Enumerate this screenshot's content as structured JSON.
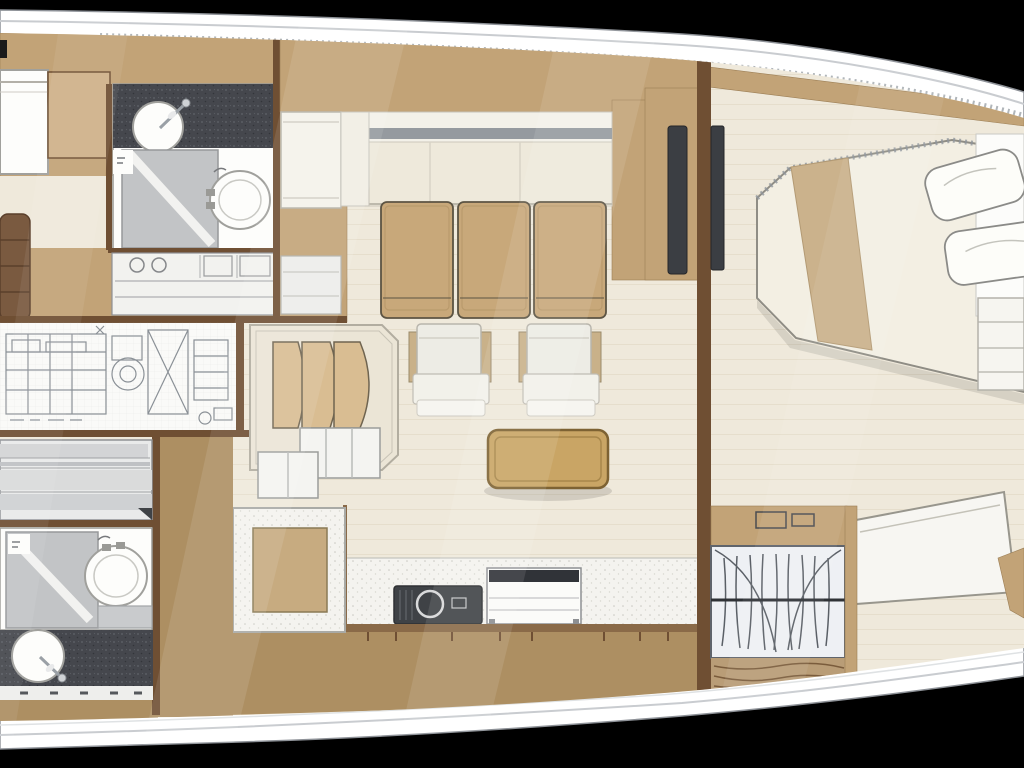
{
  "meta": {
    "title": "Sailing yacht interior deck plan",
    "description": "Top-down floor plan of a yacht interior; bow to the right, stern cropped at left"
  },
  "colors": {
    "background": "#000000",
    "hull": "#ffffff",
    "hullLine": "#c9ccd0",
    "stipple": "#8e959b",
    "wall": "#6f4f33",
    "wallLight": "#8a6a48",
    "cabinet": "#c2a377",
    "cabinetLight": "#cfb189",
    "deck": "#ad8f62",
    "floor": "#efe9db",
    "floorLine": "#ddd2bd",
    "sofa": "#f2efe6",
    "sofaStripe": "#959a9f",
    "chair": "#c8a87a",
    "chairOutline": "#5c5443",
    "armchair": "#edece5",
    "armchairArm": "#c9b189",
    "table": "#c9a565",
    "tableEdge": "#7d6233",
    "counterDark": "#45474d",
    "counterSpeckle": "#f4f3ef",
    "fixtureWhite": "#fdfdfb",
    "fixtureOutline": "#a0a09c",
    "showerGray": "#c2c4c6",
    "machinery": "#8a9096",
    "bedMattress": "#f3efe3",
    "bedBlanket": "#cbb28c",
    "bedStripe": "#d3d4d6",
    "stepsBrown": "#7a5a40",
    "tv": "#3b3e43",
    "wardrobe": "#eef0f4",
    "wardrobeLine": "#5f646c",
    "settee": "#d9bd92"
  },
  "rooms": {
    "aft_cabin_port": {
      "label": "Aft cabin (port)"
    },
    "ensuite_port": {
      "label": "Ensuite head with shower (port)"
    },
    "engine_room": {
      "label": "Engine room"
    },
    "aft_cabin_starboard": {
      "label": "Aft cabin (starboard)"
    },
    "ensuite_starboard": {
      "label": "Ensuite head with shower (starboard)"
    },
    "salon": {
      "label": "Salon"
    },
    "galley": {
      "label": "Galley"
    },
    "nav_station": {
      "label": "Nav station"
    },
    "forward_cabin": {
      "label": "Owner's cabin (forward)"
    },
    "wardrobe": {
      "label": "Hanging wardrobe"
    }
  },
  "furniture": {
    "hull": {
      "label": "Hull and side decks"
    },
    "sofa": {
      "label": "Salon sofa"
    },
    "sideboard": {
      "label": "Sideboard"
    },
    "dining_chairs": {
      "label": "Salon chairs",
      "count": 3
    },
    "armchairs": {
      "label": "Armchairs",
      "count": 2
    },
    "coffee_table": {
      "label": "Coffee table"
    },
    "settee": {
      "label": "Curved settee"
    },
    "stairs": {
      "label": "Companionway steps"
    },
    "landing": {
      "label": "Lower landing"
    },
    "owners_bed": {
      "label": "Owner's double berth"
    },
    "pillows": {
      "label": "Pillows",
      "count": 2
    },
    "forward_berth": {
      "label": "Forward cabin bench"
    },
    "shelf_unit": {
      "label": "Bow shelf unit"
    },
    "berth_port": {
      "label": "Berth (port aft cabin)"
    },
    "berth_starboard": {
      "label": "Double berth (starboard aft cabin)"
    },
    "shower_port": {
      "label": "Shower (port)"
    },
    "shower_starboard": {
      "label": "Shower (starboard)"
    },
    "toilet_port": {
      "label": "Toilet (port)"
    },
    "toilet_starboard": {
      "label": "Toilet (starboard)"
    },
    "washbasin_port": {
      "label": "Washbasin (port)"
    },
    "washbasin_starboard": {
      "label": "Washbasin (starboard)"
    },
    "dresser": {
      "label": "Dresser with drawers"
    },
    "nav_instruments": {
      "label": "Instrument panel"
    },
    "galley_sink": {
      "label": "Galley sink"
    },
    "stove": {
      "label": "Stove and oven"
    },
    "tv_salon": {
      "label": "TV screen (salon side)"
    },
    "tv_cabin": {
      "label": "TV screen (cabin side)"
    },
    "machinery": {
      "label": "Engine and systems drawing"
    },
    "hanging_clothes": {
      "label": "Clothes on hangers"
    }
  }
}
